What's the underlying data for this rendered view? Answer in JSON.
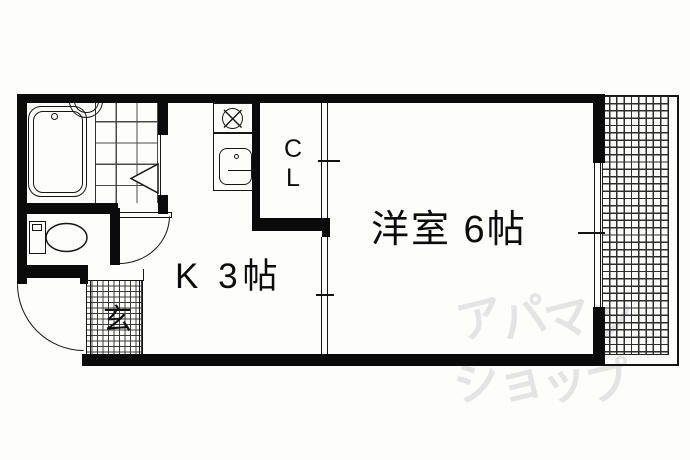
{
  "plan": {
    "labels": {
      "western_room": "洋室 6帖",
      "kitchen": "K 3帖",
      "closet": "C\nL",
      "entrance": "玄"
    },
    "watermark": {
      "line1": "アパマン",
      "line2": "ショップ"
    },
    "colors": {
      "wall": "#0b0b0b",
      "line": "#141414",
      "watermark": "#e4e4e4",
      "background": "#fdfdfc"
    }
  }
}
